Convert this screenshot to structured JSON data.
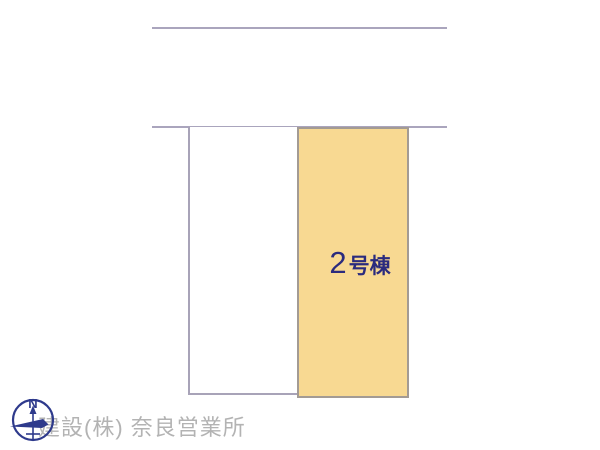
{
  "plan": {
    "background_color": "#ffffff",
    "road_line_color": "#aaa5bd",
    "lots": [
      {
        "name": "adjacent-lot",
        "fill": "#ffffff",
        "border_color": "#a8a3b8"
      },
      {
        "name": "lot-2",
        "fill": "#f8d992",
        "border_color": "#a39b94",
        "label_number": "2",
        "label_suffix": "号棟",
        "label_color": "#2b2b7e"
      }
    ]
  },
  "compass": {
    "north_label": "N",
    "color": "#2e3a8c"
  },
  "watermark": {
    "text": "建設(株) 奈良営業所",
    "color": "#b3b3b3"
  }
}
